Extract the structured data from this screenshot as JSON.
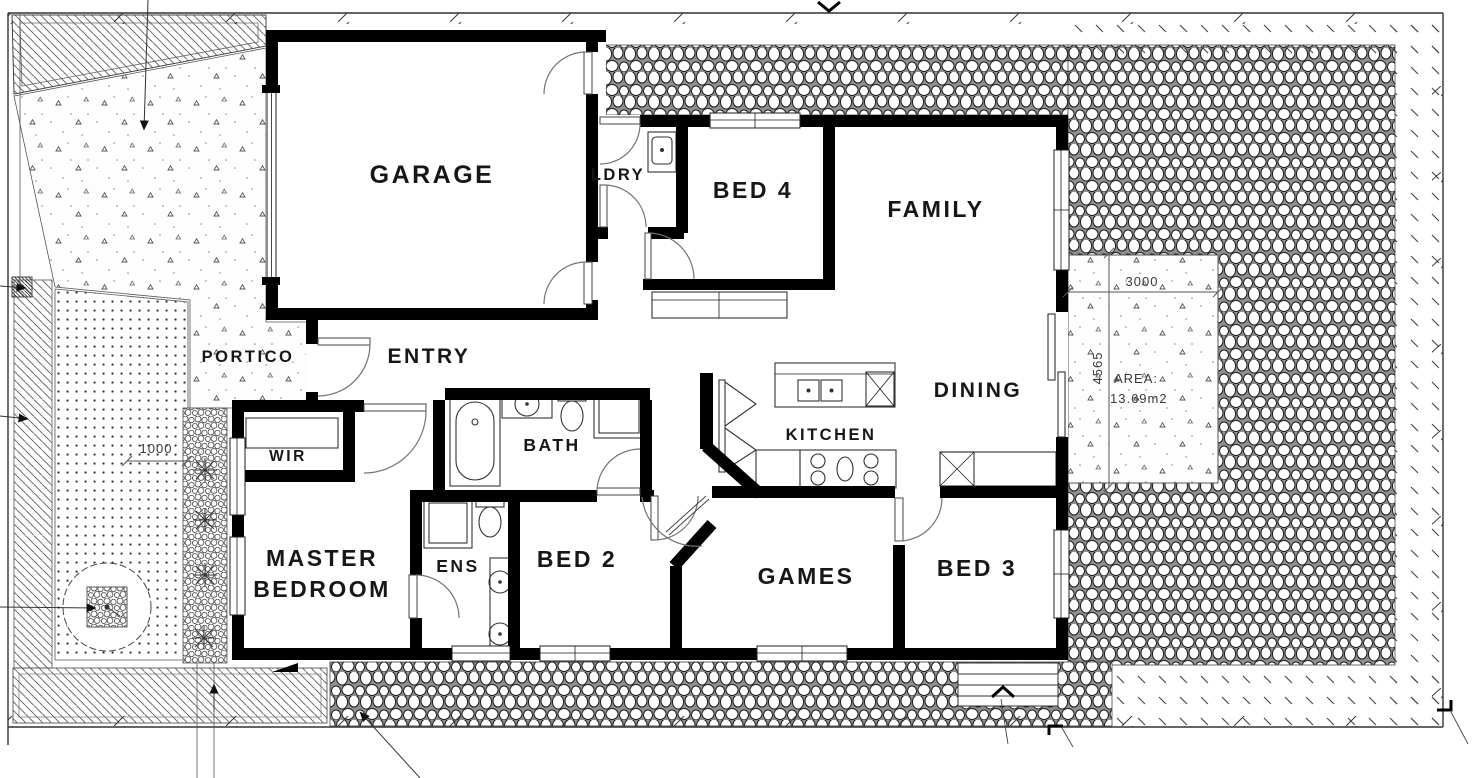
{
  "rooms": {
    "garage": "GARAGE",
    "ldry": "LDRY",
    "bed4": "BED 4",
    "family": "FAMILY",
    "portico": "PORTICO",
    "entry": "ENTRY",
    "wir": "WIR",
    "bath": "BATH",
    "kitchen": "KITCHEN",
    "dining": "DINING",
    "master_line1": "MASTER",
    "master_line2": "BEDROOM",
    "ens": "ENS",
    "bed2": "BED 2",
    "games": "GAMES",
    "bed3": "BED 3"
  },
  "dimensions": {
    "patio_width": "3000",
    "patio_depth": "4565",
    "patio_area_label": "AREA:",
    "patio_area_value": "13.69m2",
    "side_setback": "1000"
  },
  "colors": {
    "wall": "#000000",
    "paper": "#ffffff",
    "linework": "#333333"
  }
}
